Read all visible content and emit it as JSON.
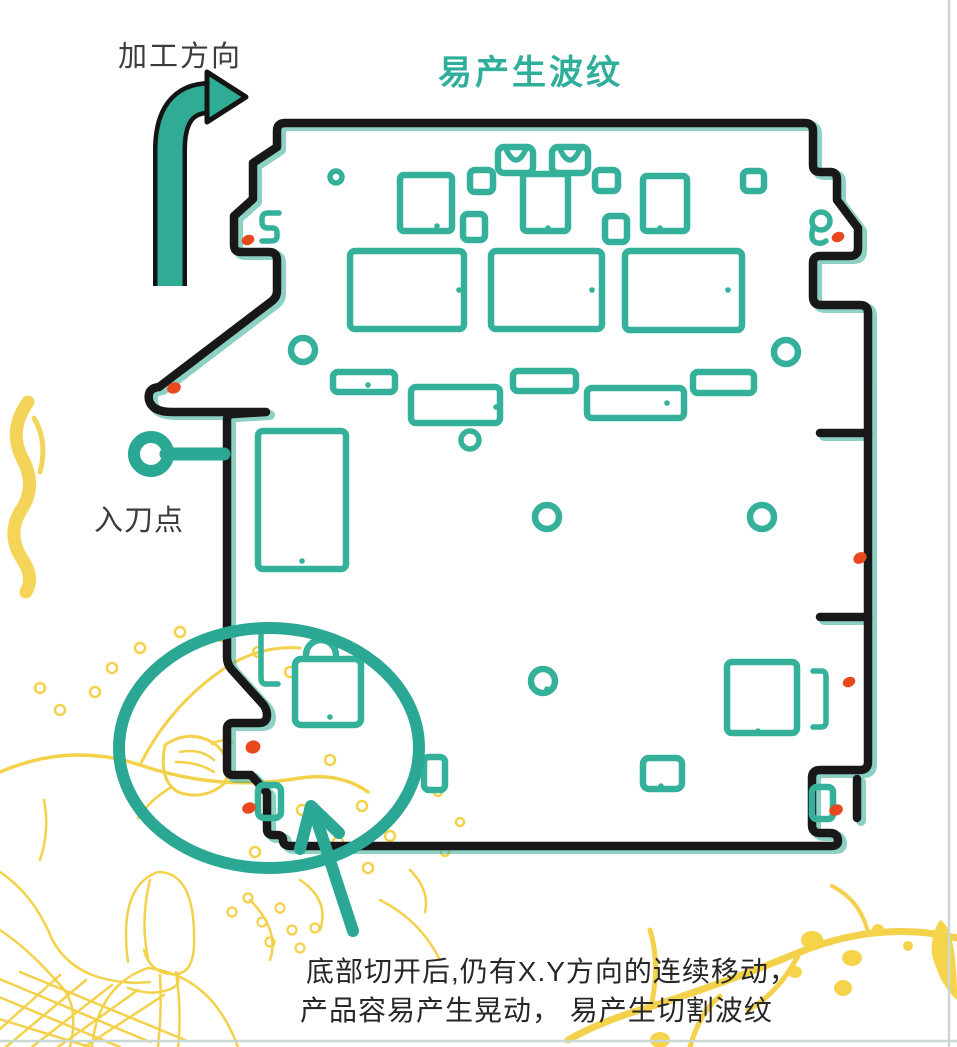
{
  "figure": {
    "type": "machining-diagram",
    "subject": "pcb-panel-cutting-ripple-illustration"
  },
  "labels": {
    "processing_direction": "加工方向",
    "ripple_warning_title": "易产生波纹",
    "entry_point": "入刀点",
    "bottom_note_line1": "底部切开后,仍有X.Y方向的连续移动，",
    "bottom_note_line2": "产品容易产生晃动， 易产生切割波纹"
  },
  "icons": {
    "direction_arrow": "curved-arrow-up-right",
    "entry_point_marker": "ring-with-stem",
    "highlight_ellipse": "emphasis-oval",
    "callout_arrow": "arrow-up-left",
    "defect_markers": "red-diamond-dots"
  },
  "colors": {
    "teal_annotation": "#2ba894",
    "teal_component": "#35b19b",
    "teal_title": "#2fae9b",
    "outline_black": "#181818",
    "marker_red": "#e8481e",
    "decor_yellow": "#f3d14a",
    "frame_line": "#c9d8d3",
    "text_dark": "#3c3c3c",
    "background": "#ffffff"
  }
}
